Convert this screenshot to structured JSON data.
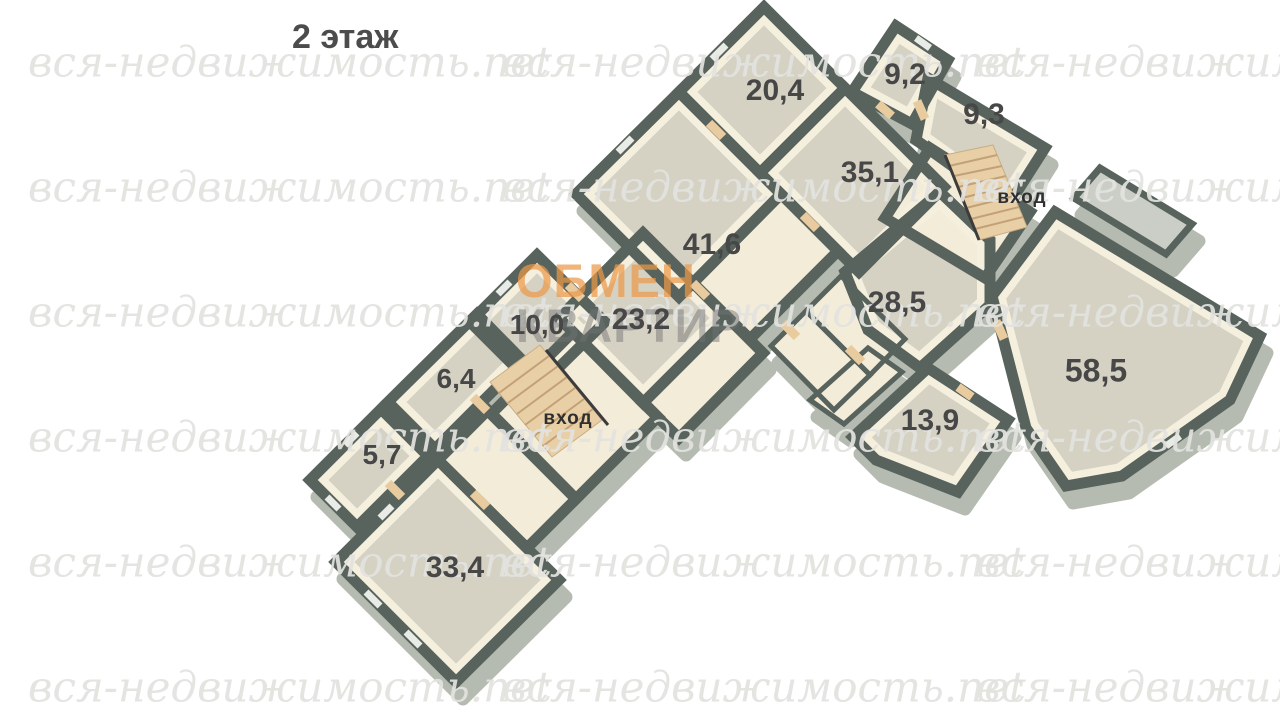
{
  "title": "2 этаж",
  "watermark": {
    "tile_text": "вся-недвижимость.net",
    "brand_line1": "ОБМЕН",
    "brand_line2": "КВАРТИР"
  },
  "plan": {
    "floor_name": "2 этаж",
    "rooms": [
      {
        "id": "room-20-4",
        "label": "20,4"
      },
      {
        "id": "room-9-2",
        "label": "9,2"
      },
      {
        "id": "room-9-3",
        "label": "9,3"
      },
      {
        "id": "room-35-1",
        "label": "35,1"
      },
      {
        "id": "room-41-6",
        "label": "41,6"
      },
      {
        "id": "room-28-5",
        "label": "28,5"
      },
      {
        "id": "room-10-0",
        "label": "10,0"
      },
      {
        "id": "room-23-2",
        "label": "23,2"
      },
      {
        "id": "room-58-5",
        "label": "58,5"
      },
      {
        "id": "room-6-4",
        "label": "6,4"
      },
      {
        "id": "room-13-9",
        "label": "13,9"
      },
      {
        "id": "room-5-7",
        "label": "5,7"
      },
      {
        "id": "room-33-4",
        "label": "33,4"
      }
    ],
    "entrances": [
      {
        "id": "entrance-right",
        "label": "вход"
      },
      {
        "id": "entrance-left",
        "label": "вход"
      }
    ]
  },
  "colors": {
    "wall": "#57635c",
    "floor": "#d5d2c4",
    "hall_floor": "#f3ecd8",
    "inner_wall_face": "#f5efde",
    "stairs": "#e9cfa6",
    "door": "#e9cba0",
    "balcony": "#cbcec6",
    "skirt": "#b5bbb1",
    "label_text": "#474747",
    "title_text": "#4c4c4c",
    "brand_orange": "#eb9848",
    "brand_gray": "#737373",
    "watermark_gray": "#e2e2df"
  }
}
